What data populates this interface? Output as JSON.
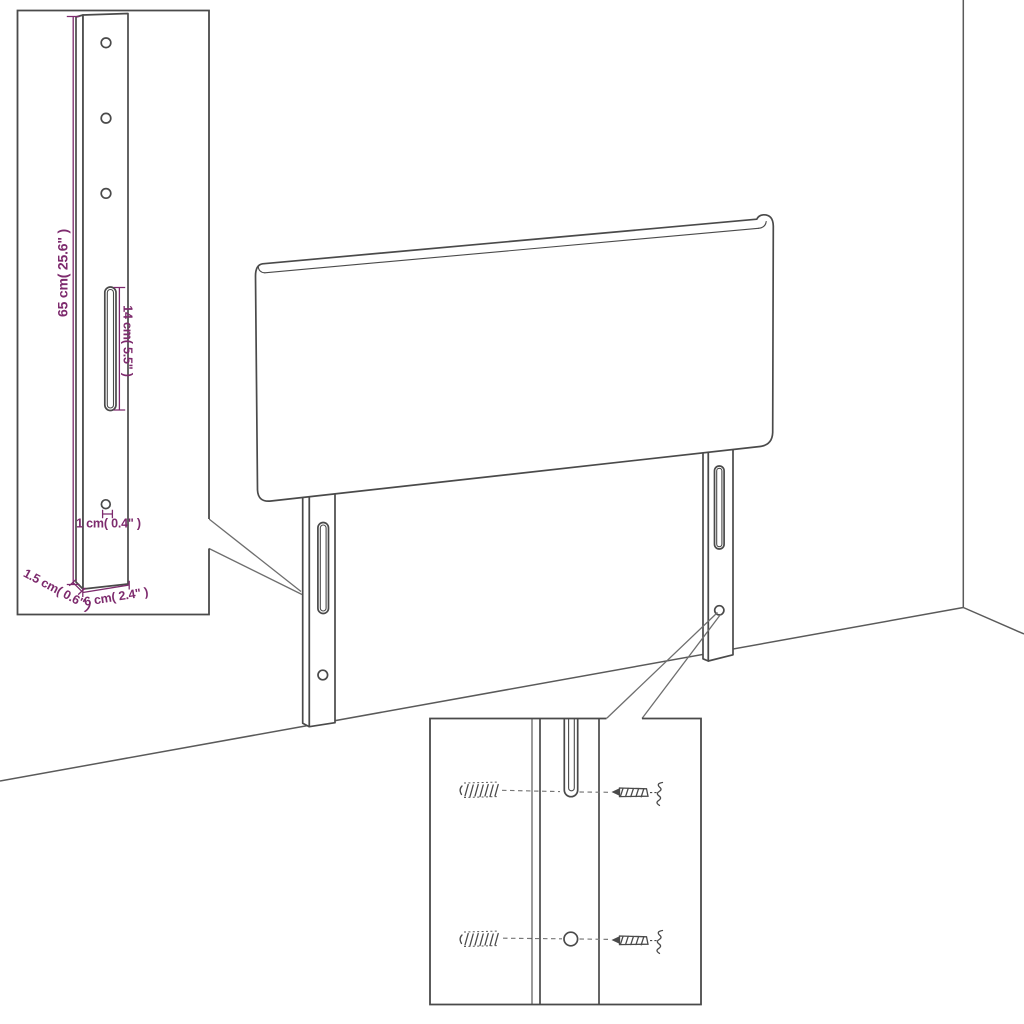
{
  "diagram": {
    "description": "headboard-dimension-diagram",
    "colors": {
      "background": "#ffffff",
      "line": "#4a4a4a",
      "dimension_accent": "#7d2a6d"
    },
    "bracket_inset": {
      "dim_height": "65 cm( 25.6\" )",
      "dim_slot": "14 cm( 5.5\" )",
      "dim_hole": "1 cm( 0.4\" )",
      "dim_thickness": "1.5 cm( 0.6\" )",
      "dim_width": "6 cm( 2.4\" )"
    },
    "mounting_inset": {
      "hardware": [
        "wall-plug-icon",
        "screw-icon"
      ]
    }
  }
}
